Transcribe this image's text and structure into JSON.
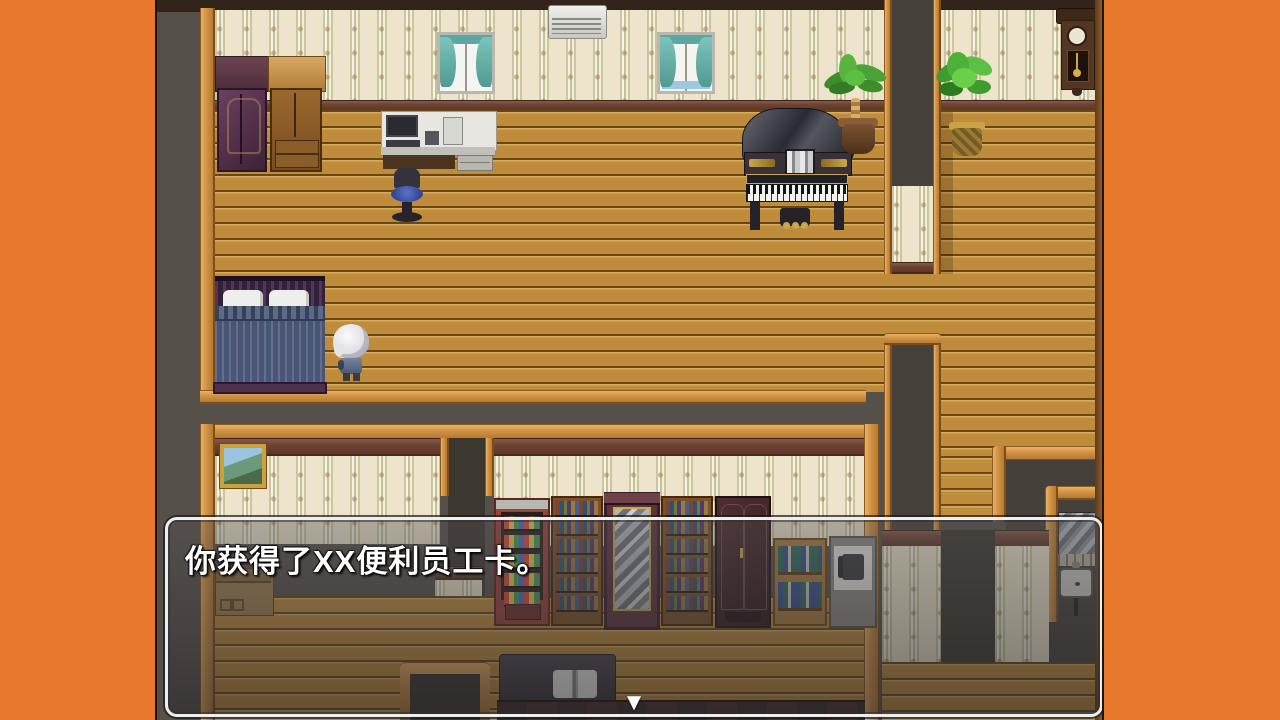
{
  "dialog": {
    "text": "你获得了XX便利员工卡。",
    "continue_indicator": "▼"
  },
  "scene": {
    "style": "top-down RPG interior (RPG Maker style)",
    "player": "white-haired chibi character standing beside the bed",
    "objects": [
      "purple wardrobe",
      "wooden cabinet",
      "curtained window left",
      "air conditioner",
      "curtained window right",
      "computer desk",
      "office chair",
      "grand piano",
      "palm plant",
      "potted plant",
      "wall pendulum clock",
      "double bed",
      "framed picture",
      "vending machine",
      "bookshelf",
      "mirror cabinet",
      "second bookshelf",
      "dark wardrobe",
      "low bookshelf",
      "telephone desk",
      "bathroom sink",
      "reading table with open book",
      "storage crate",
      "doorway"
    ]
  },
  "colors": {
    "letterbox": "#e8782c",
    "outside_walls": "#55514a",
    "floor_wood": "#bf8c3c",
    "wallpaper": "#ede4cb",
    "trim_orange": "#d19244",
    "trim_maroon": "#6e4334",
    "dialog_border": "#eeeeee",
    "dialog_text": "#ffffff"
  }
}
